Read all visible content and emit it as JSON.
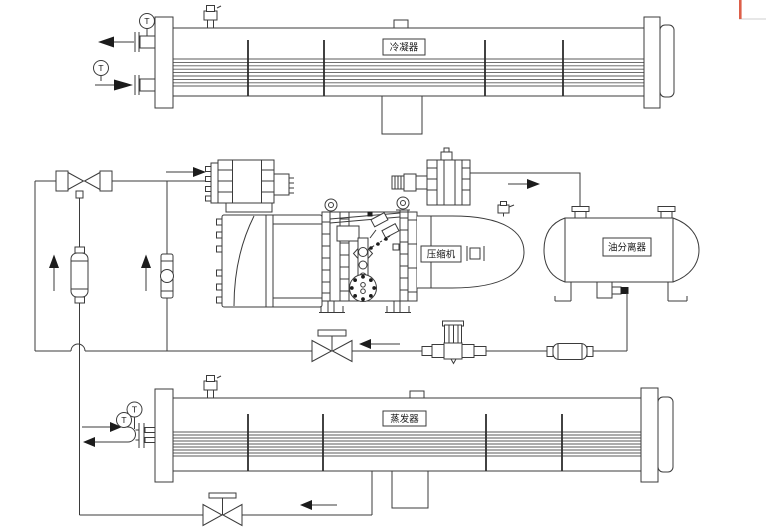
{
  "diagram": {
    "kind": "refrigeration-system-schematic",
    "labels": {
      "condenser": "冷凝器",
      "evaporator": "蒸发器",
      "compressor": "压缩机",
      "oil_separator": "油分离器",
      "temperature_sensor": "T"
    },
    "colors": {
      "line": "#3b3b3b",
      "background": "#ffffff",
      "artifact_red": "#dd5f49"
    }
  }
}
